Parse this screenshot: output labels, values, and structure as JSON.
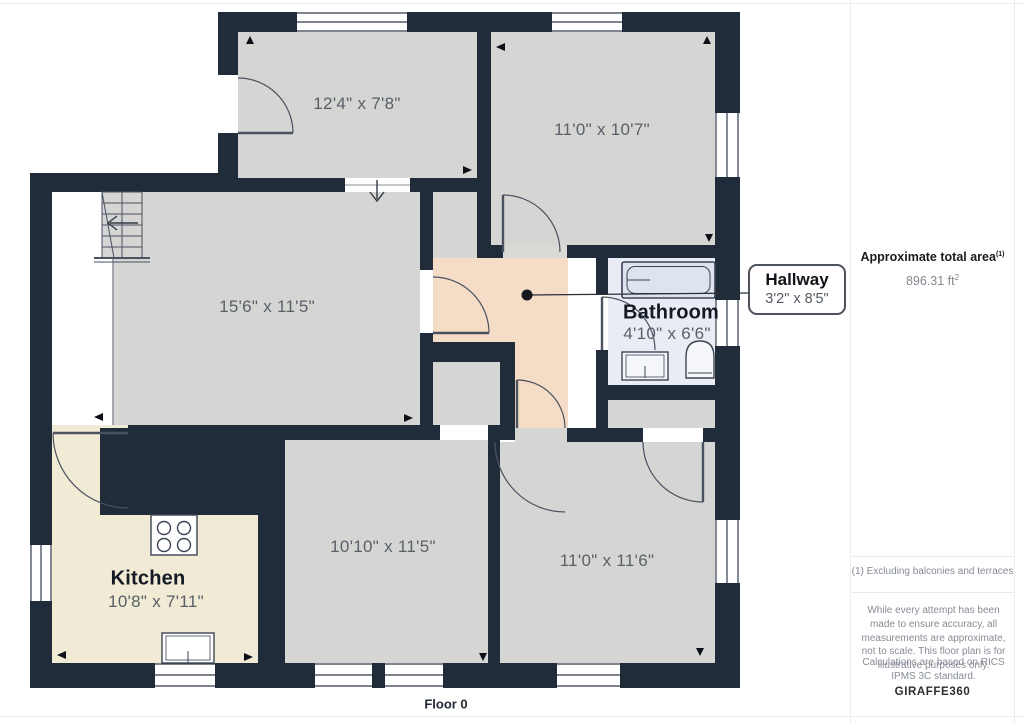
{
  "plan": {
    "floor_label": "Floor 0",
    "rooms": [
      {
        "id": "room-top-left",
        "dims": "12'4\" x 7'8\""
      },
      {
        "id": "room-top-right",
        "dims": "11'0\" x 10'7\""
      },
      {
        "id": "living-room",
        "dims": "15'6\" x 11'5\""
      },
      {
        "id": "bathroom",
        "name": "Bathroom",
        "dims": "4'10\" x 6'6\""
      },
      {
        "id": "kitchen",
        "name": "Kitchen",
        "dims": "10'8\" x 7'11\""
      },
      {
        "id": "room-bottom-middle",
        "dims": "10'10\" x 11'5\""
      },
      {
        "id": "room-bottom-right",
        "dims": "11'0\" x 11'6\""
      }
    ],
    "callout": {
      "name": "Hallway",
      "dims": "3'2\" x 8'5\""
    },
    "colors": {
      "wall": "#212c3a",
      "floor_gray": "#d5d6d4",
      "kitchen_floor": "#f1ead5",
      "hallway_floor": "#f5dcc6",
      "bathroom_floor": "#e9ecf4",
      "tub_fill": "#dde3ef"
    }
  },
  "sidebar": {
    "area_title": "Approximate total area",
    "area_title_sup": "(1)",
    "area_value": "896.31 ft",
    "area_value_sup": "2",
    "note": "(1) Excluding balconies and terraces",
    "disclaimer1": "While every attempt has been made to ensure accuracy, all measurements are approximate, not to scale. This floor plan is for illustrative purposes only.",
    "disclaimer2": "Calculations are based on RICS IPMS 3C standard.",
    "brand": {
      "name": "GIRAFFE",
      "suffix": "360"
    }
  }
}
